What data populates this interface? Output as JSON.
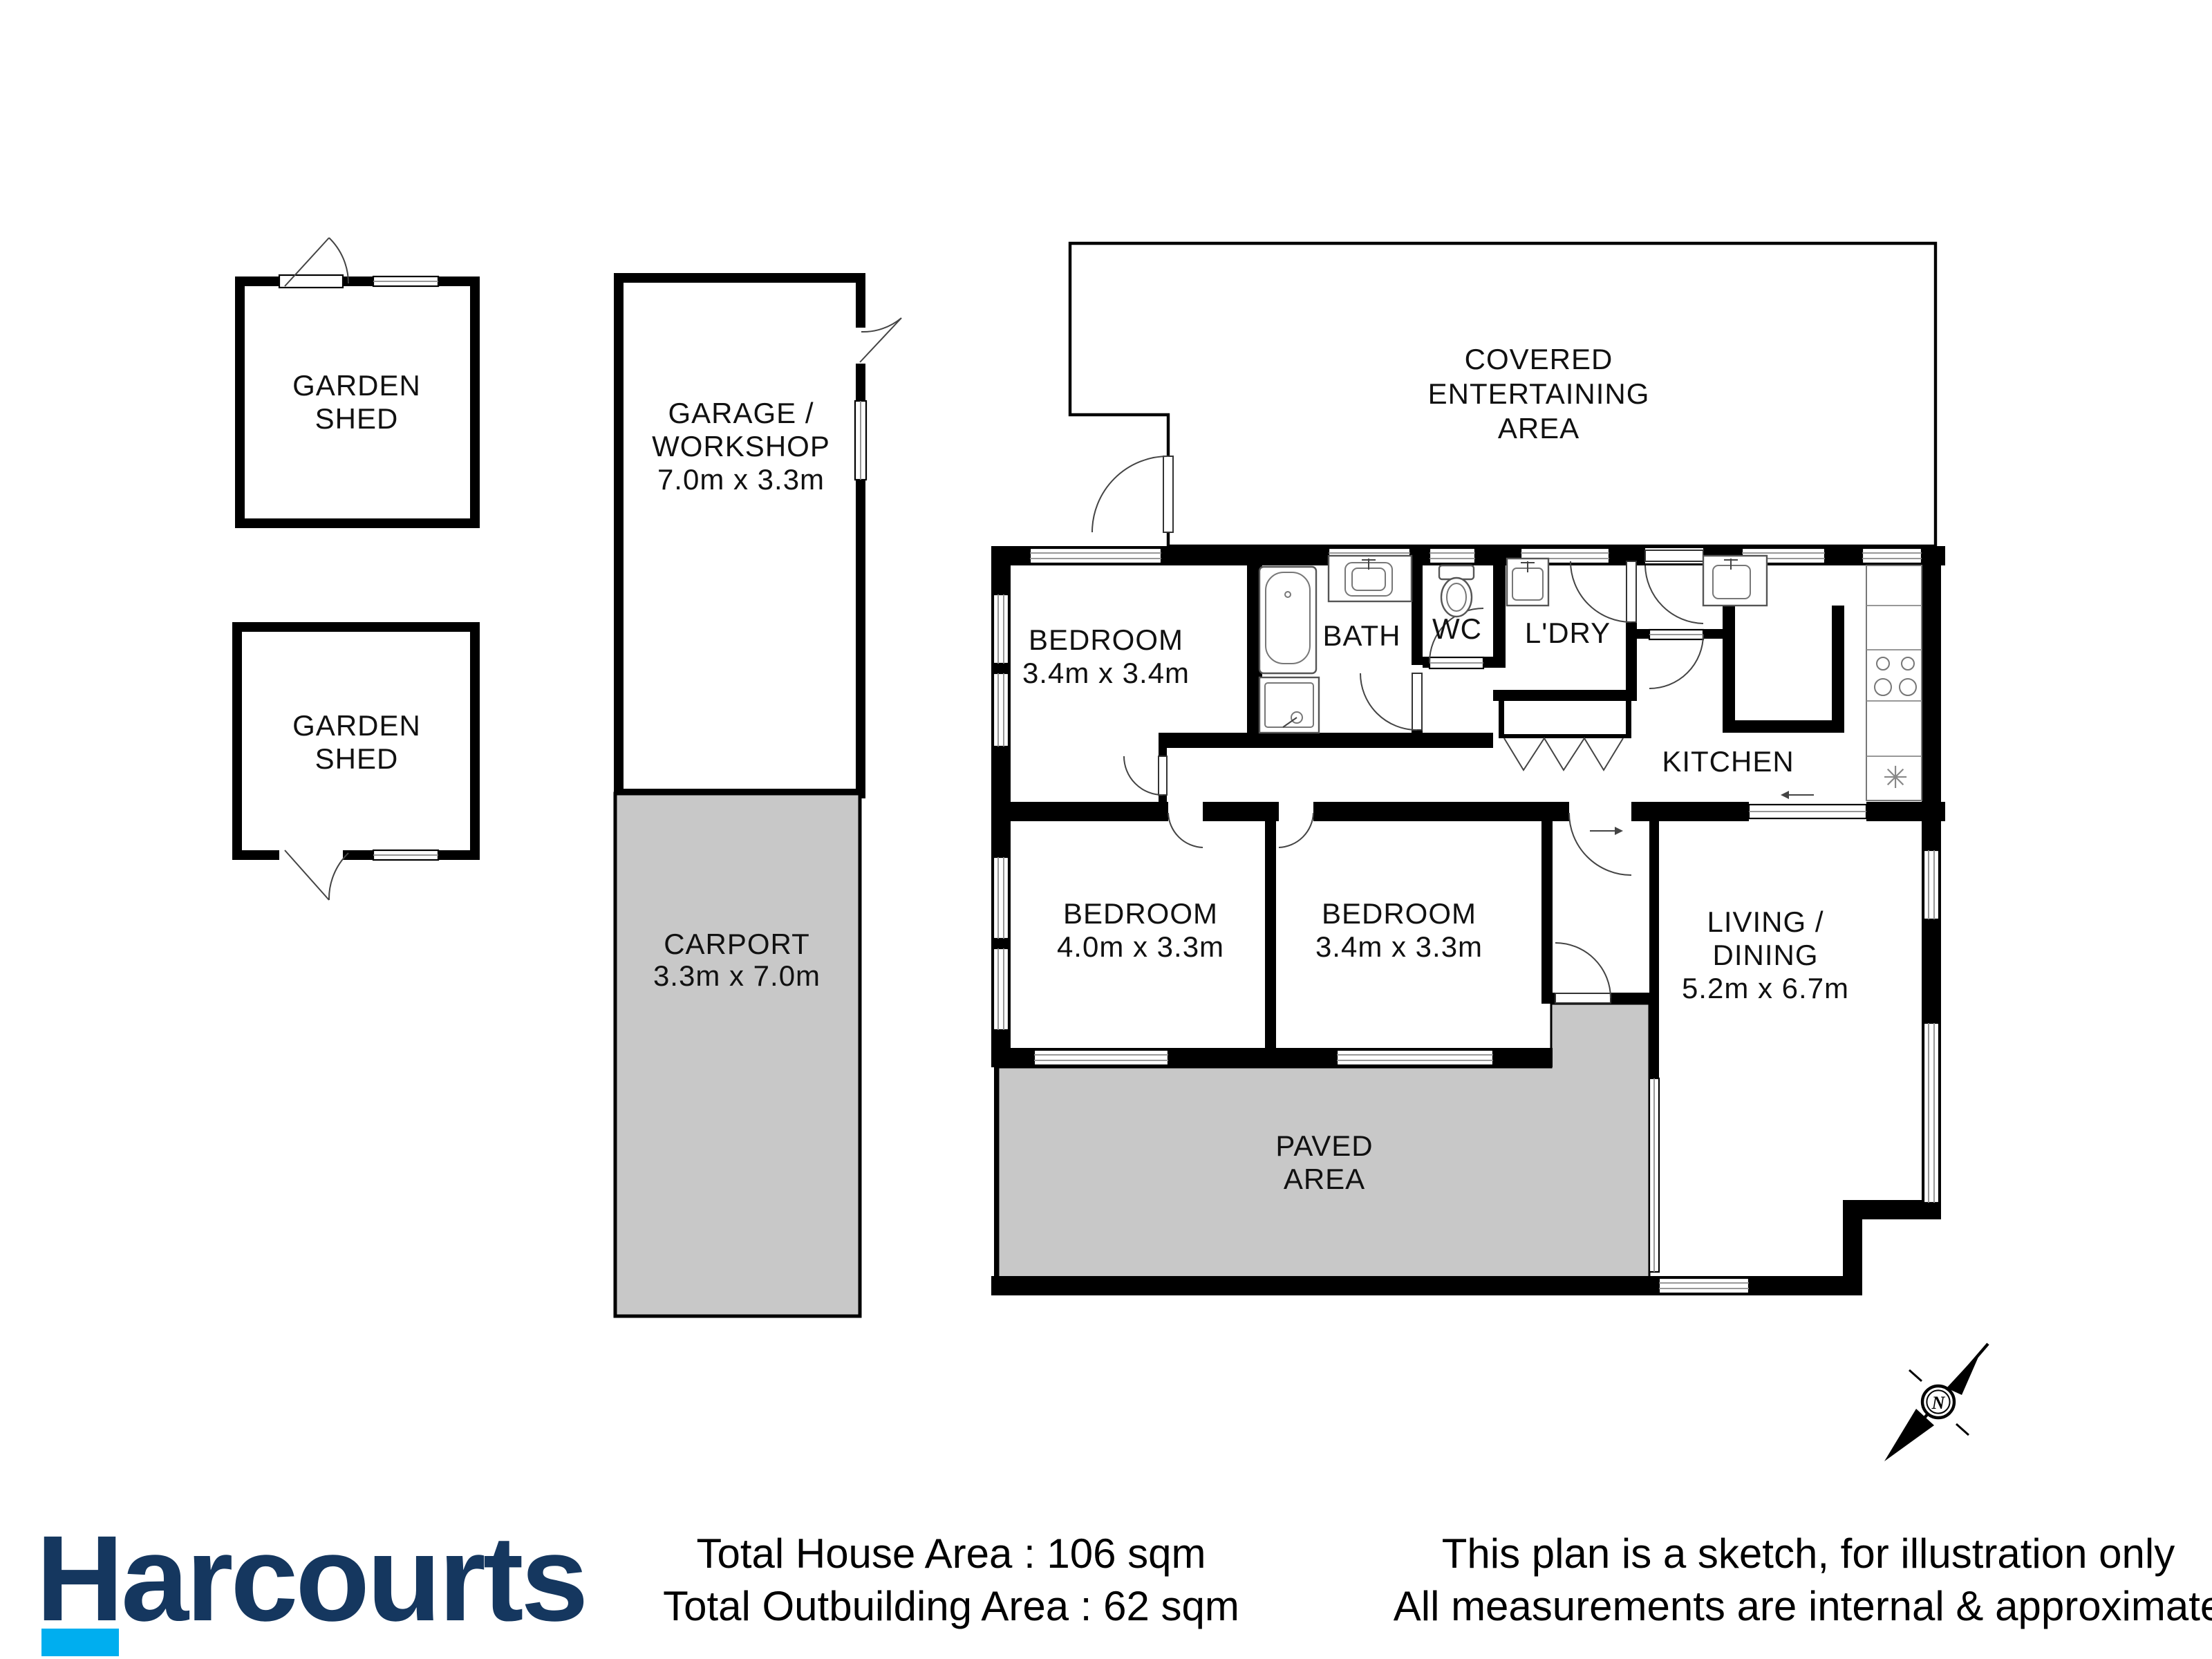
{
  "labels": {
    "shed1": [
      "GARDEN",
      "SHED"
    ],
    "shed2": [
      "GARDEN",
      "SHED"
    ],
    "garage": [
      "GARAGE /",
      "WORKSHOP",
      "7.0m x 3.3m"
    ],
    "carport": [
      "CARPORT",
      "3.3m x 7.0m"
    ],
    "covered": [
      "COVERED",
      "ENTERTAINING",
      "AREA"
    ],
    "bedroom1": [
      "BEDROOM",
      "3.4m x 3.4m"
    ],
    "bedroom2": [
      "BEDROOM",
      "4.0m x 3.3m"
    ],
    "bedroom3": [
      "BEDROOM",
      "3.4m x 3.3m"
    ],
    "bath": "BATH",
    "wc": "WC",
    "ldry": "L'DRY",
    "kitchen": "KITCHEN",
    "living": [
      "LIVING /",
      "DINING",
      "5.2m x 6.7m"
    ],
    "paved": [
      "PAVED",
      "AREA"
    ],
    "compass_n": "N"
  },
  "footer": {
    "brand": "Harcourts",
    "totals": [
      "Total House Area : 106 sqm",
      "Total Outbuilding Area : 62 sqm"
    ],
    "disclaimer": [
      "This plan is a sketch, for illustration only",
      "All measurements are internal & approximate"
    ]
  },
  "colors": {
    "wall": "#000000",
    "area_fill": "#c8c8c8",
    "brand_navy": "#15375f",
    "brand_cyan": "#00aeef"
  }
}
